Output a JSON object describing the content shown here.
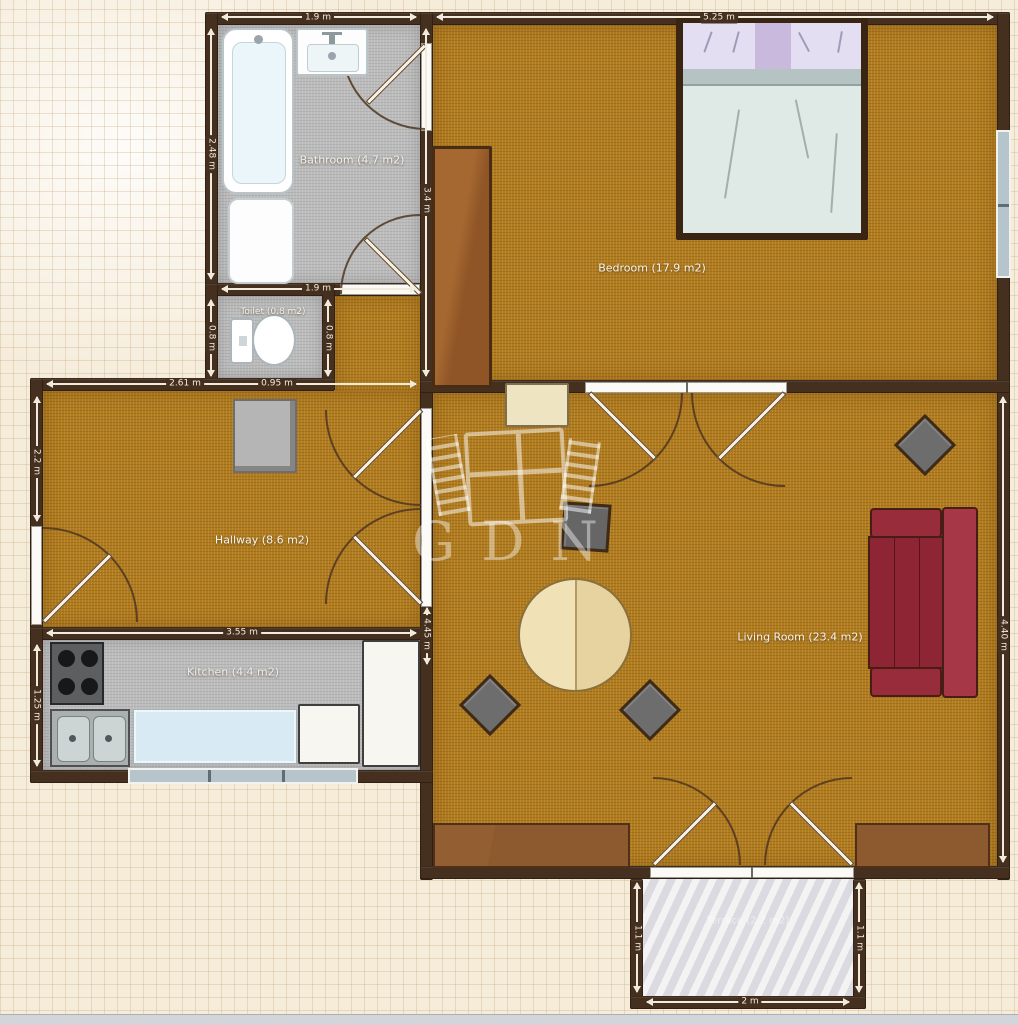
{
  "watermark": {
    "text": "GDN"
  },
  "rooms": {
    "bathroom": {
      "label": "Bathroom (4.7 m2)"
    },
    "toilet": {
      "label": "Toilet (0.8 m2)"
    },
    "bedroom": {
      "label": "Bedroom (17.9 m2)"
    },
    "hallway": {
      "label": "Hallway (8.6 m2)"
    },
    "kitchen": {
      "label": "Kitchen (4.4 m2)"
    },
    "living_room": {
      "label": "Living Room (23.4 m2)"
    },
    "terrace": {
      "label": "Terrace (2.2 m2)"
    }
  },
  "dimensions": {
    "bathroom_top": "1.9 m",
    "bathroom_left": "2.48 m",
    "bathroom_bottom": "1.9 m",
    "bedroom_top": "5.25 m",
    "bedroom_left": "3.4 m",
    "toilet_left": "0.8 m",
    "toilet_right": "0.8 m",
    "toilet_bottom": "0.95 m",
    "hallway_top": "2.61 m",
    "hallway_left": "2.2 m",
    "hallway_bottom": "3.55 m",
    "kitchen_left": "1.25 m",
    "living_left": "4.45 m",
    "living_right": "4.40 m",
    "terrace_left": "1.1 m",
    "terrace_right": "1.1 m",
    "terrace_bottom": "2 m"
  },
  "colors": {
    "wall": "#452f1e",
    "floor_wood": "#b17c20",
    "floor_tile": "#bcbcbc",
    "floor_marble": "#e7e7ea",
    "sofa_red": "#8e2534",
    "counter_blue": "#d8ebf5"
  }
}
